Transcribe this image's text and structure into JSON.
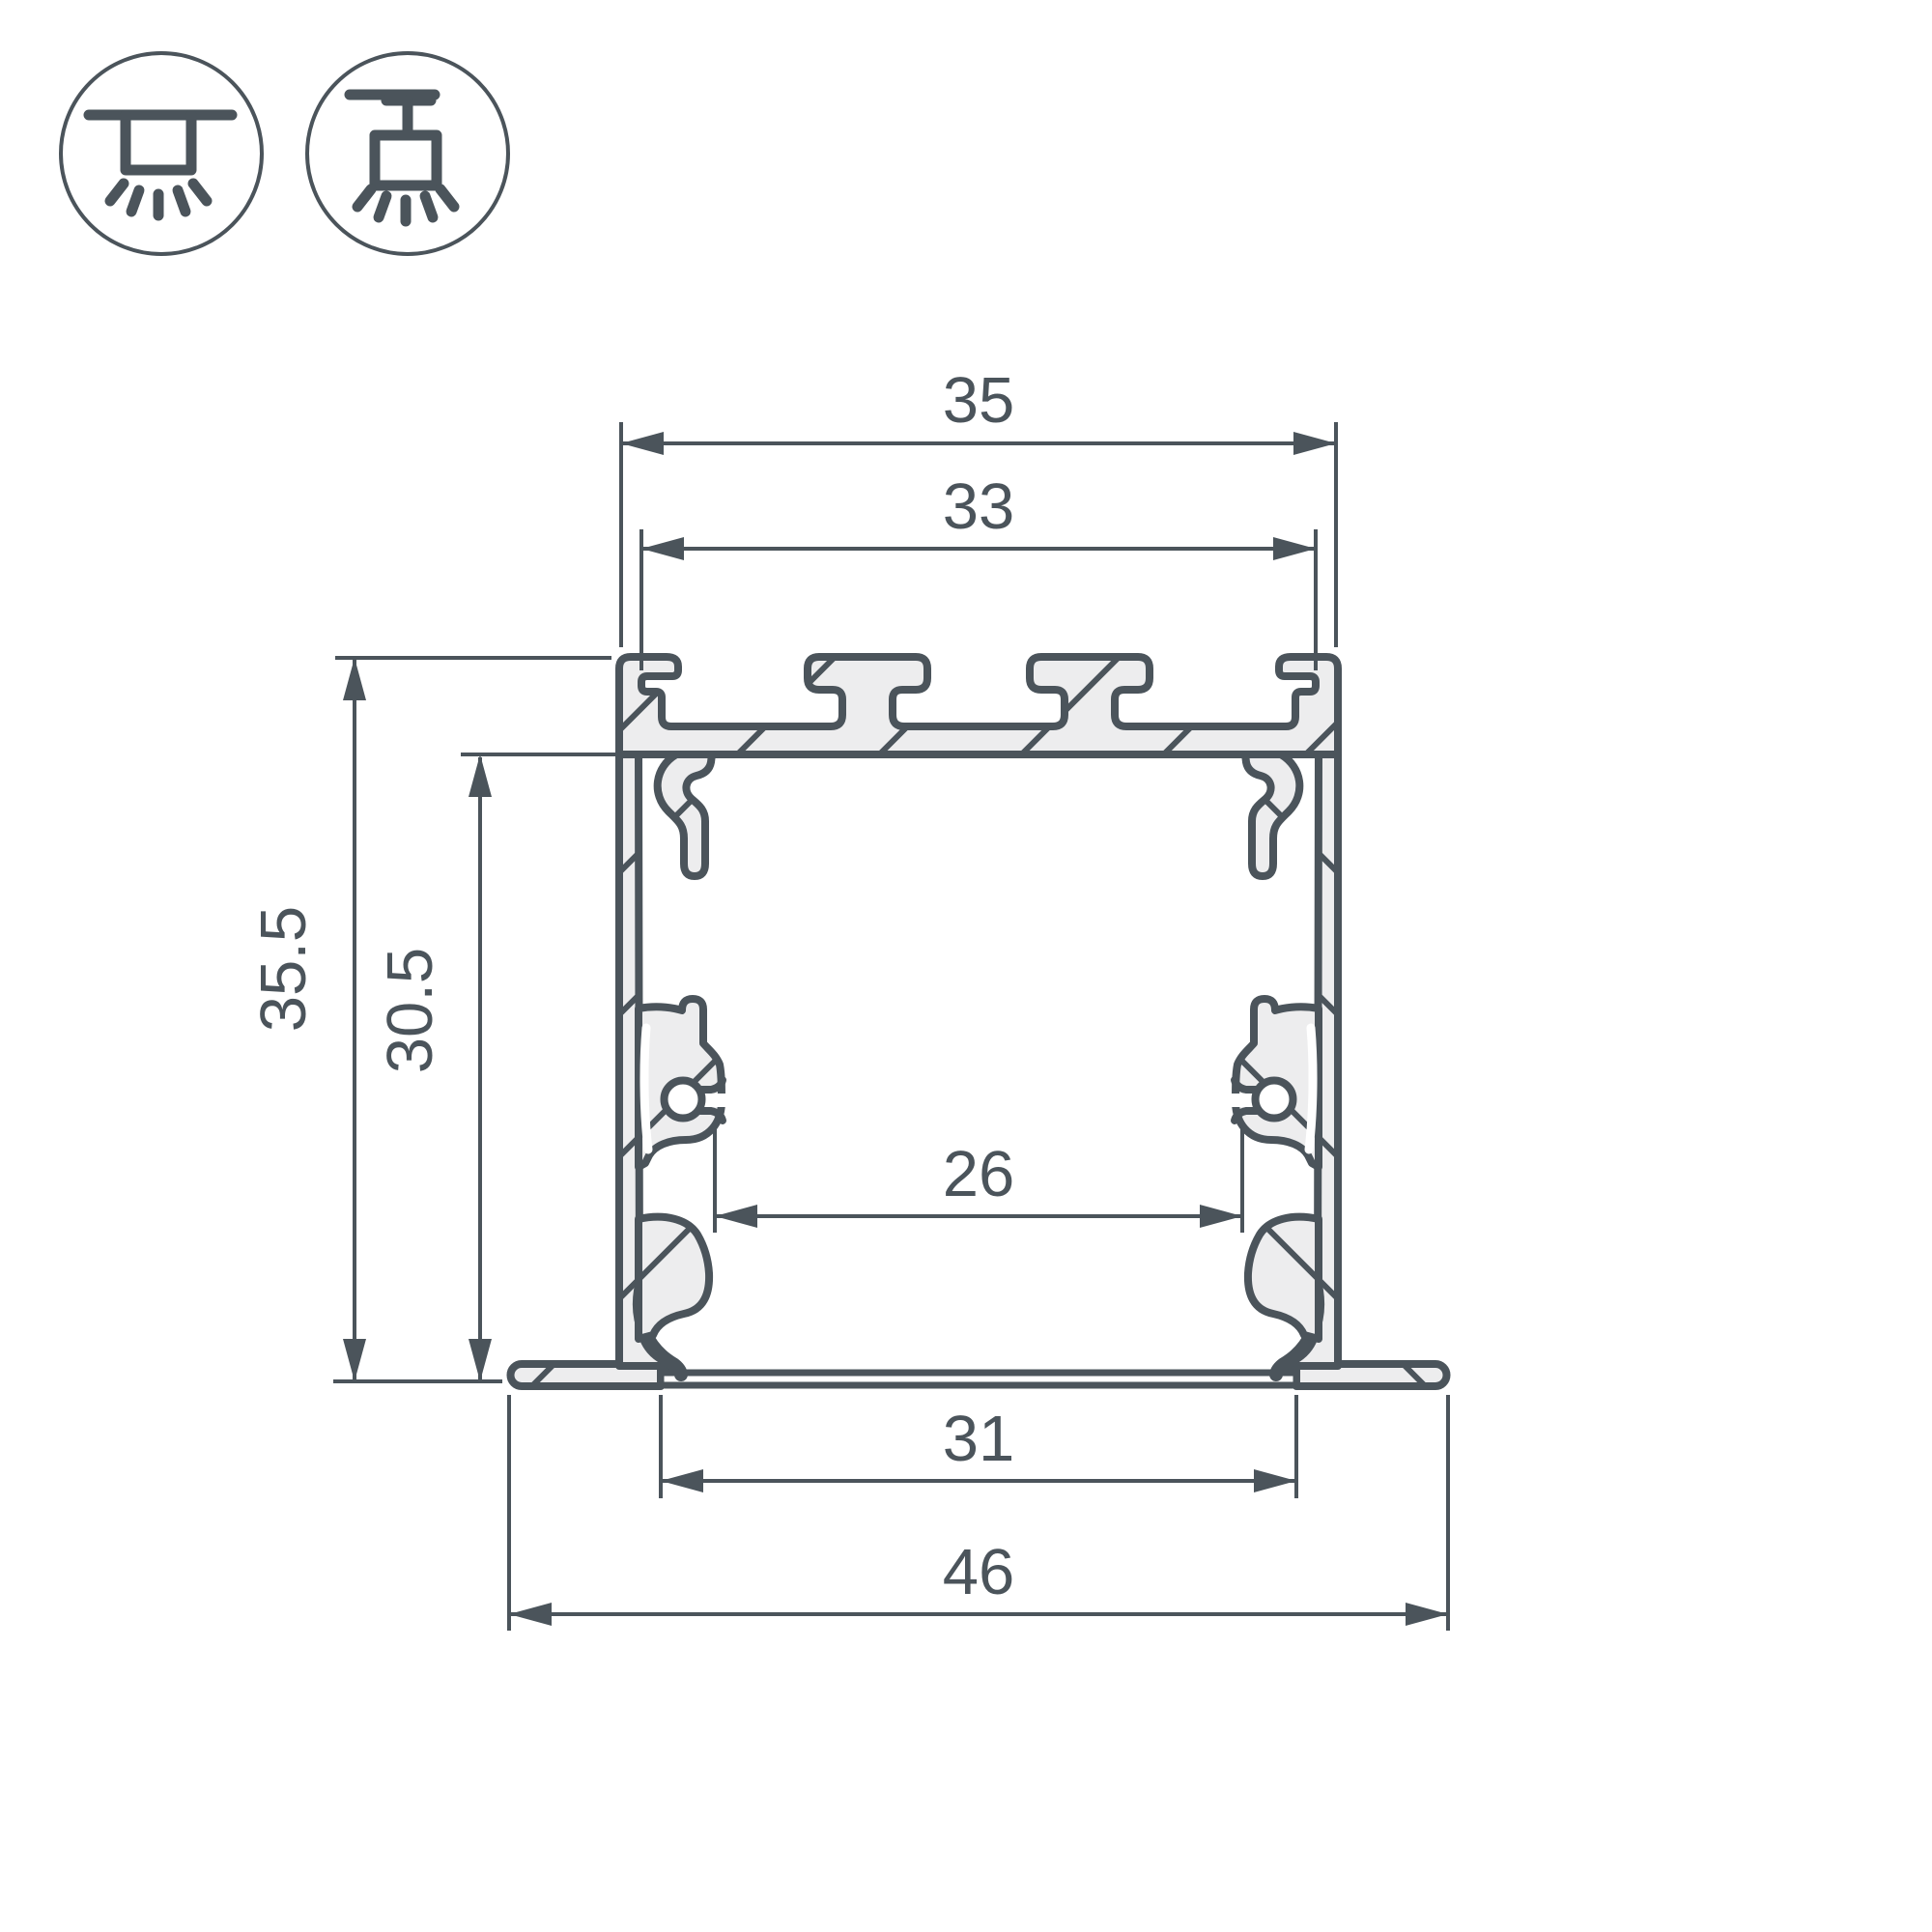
{
  "page": {
    "background": "#ffffff"
  },
  "palette": {
    "line": "#4b545b",
    "fill": "#ededee",
    "white": "#ffffff"
  },
  "icons": [
    {
      "name": "recessed-mount-icon"
    },
    {
      "name": "surface-mount-icon"
    }
  ],
  "dimensions": {
    "top_width": {
      "label": "35"
    },
    "slot_width": {
      "label": "33"
    },
    "overall_height": {
      "label": "35.5"
    },
    "inner_height": {
      "label": "30.5"
    },
    "inner_width": {
      "label": "26"
    },
    "opening_width": {
      "label": "31"
    },
    "flange_width": {
      "label": "46"
    }
  }
}
